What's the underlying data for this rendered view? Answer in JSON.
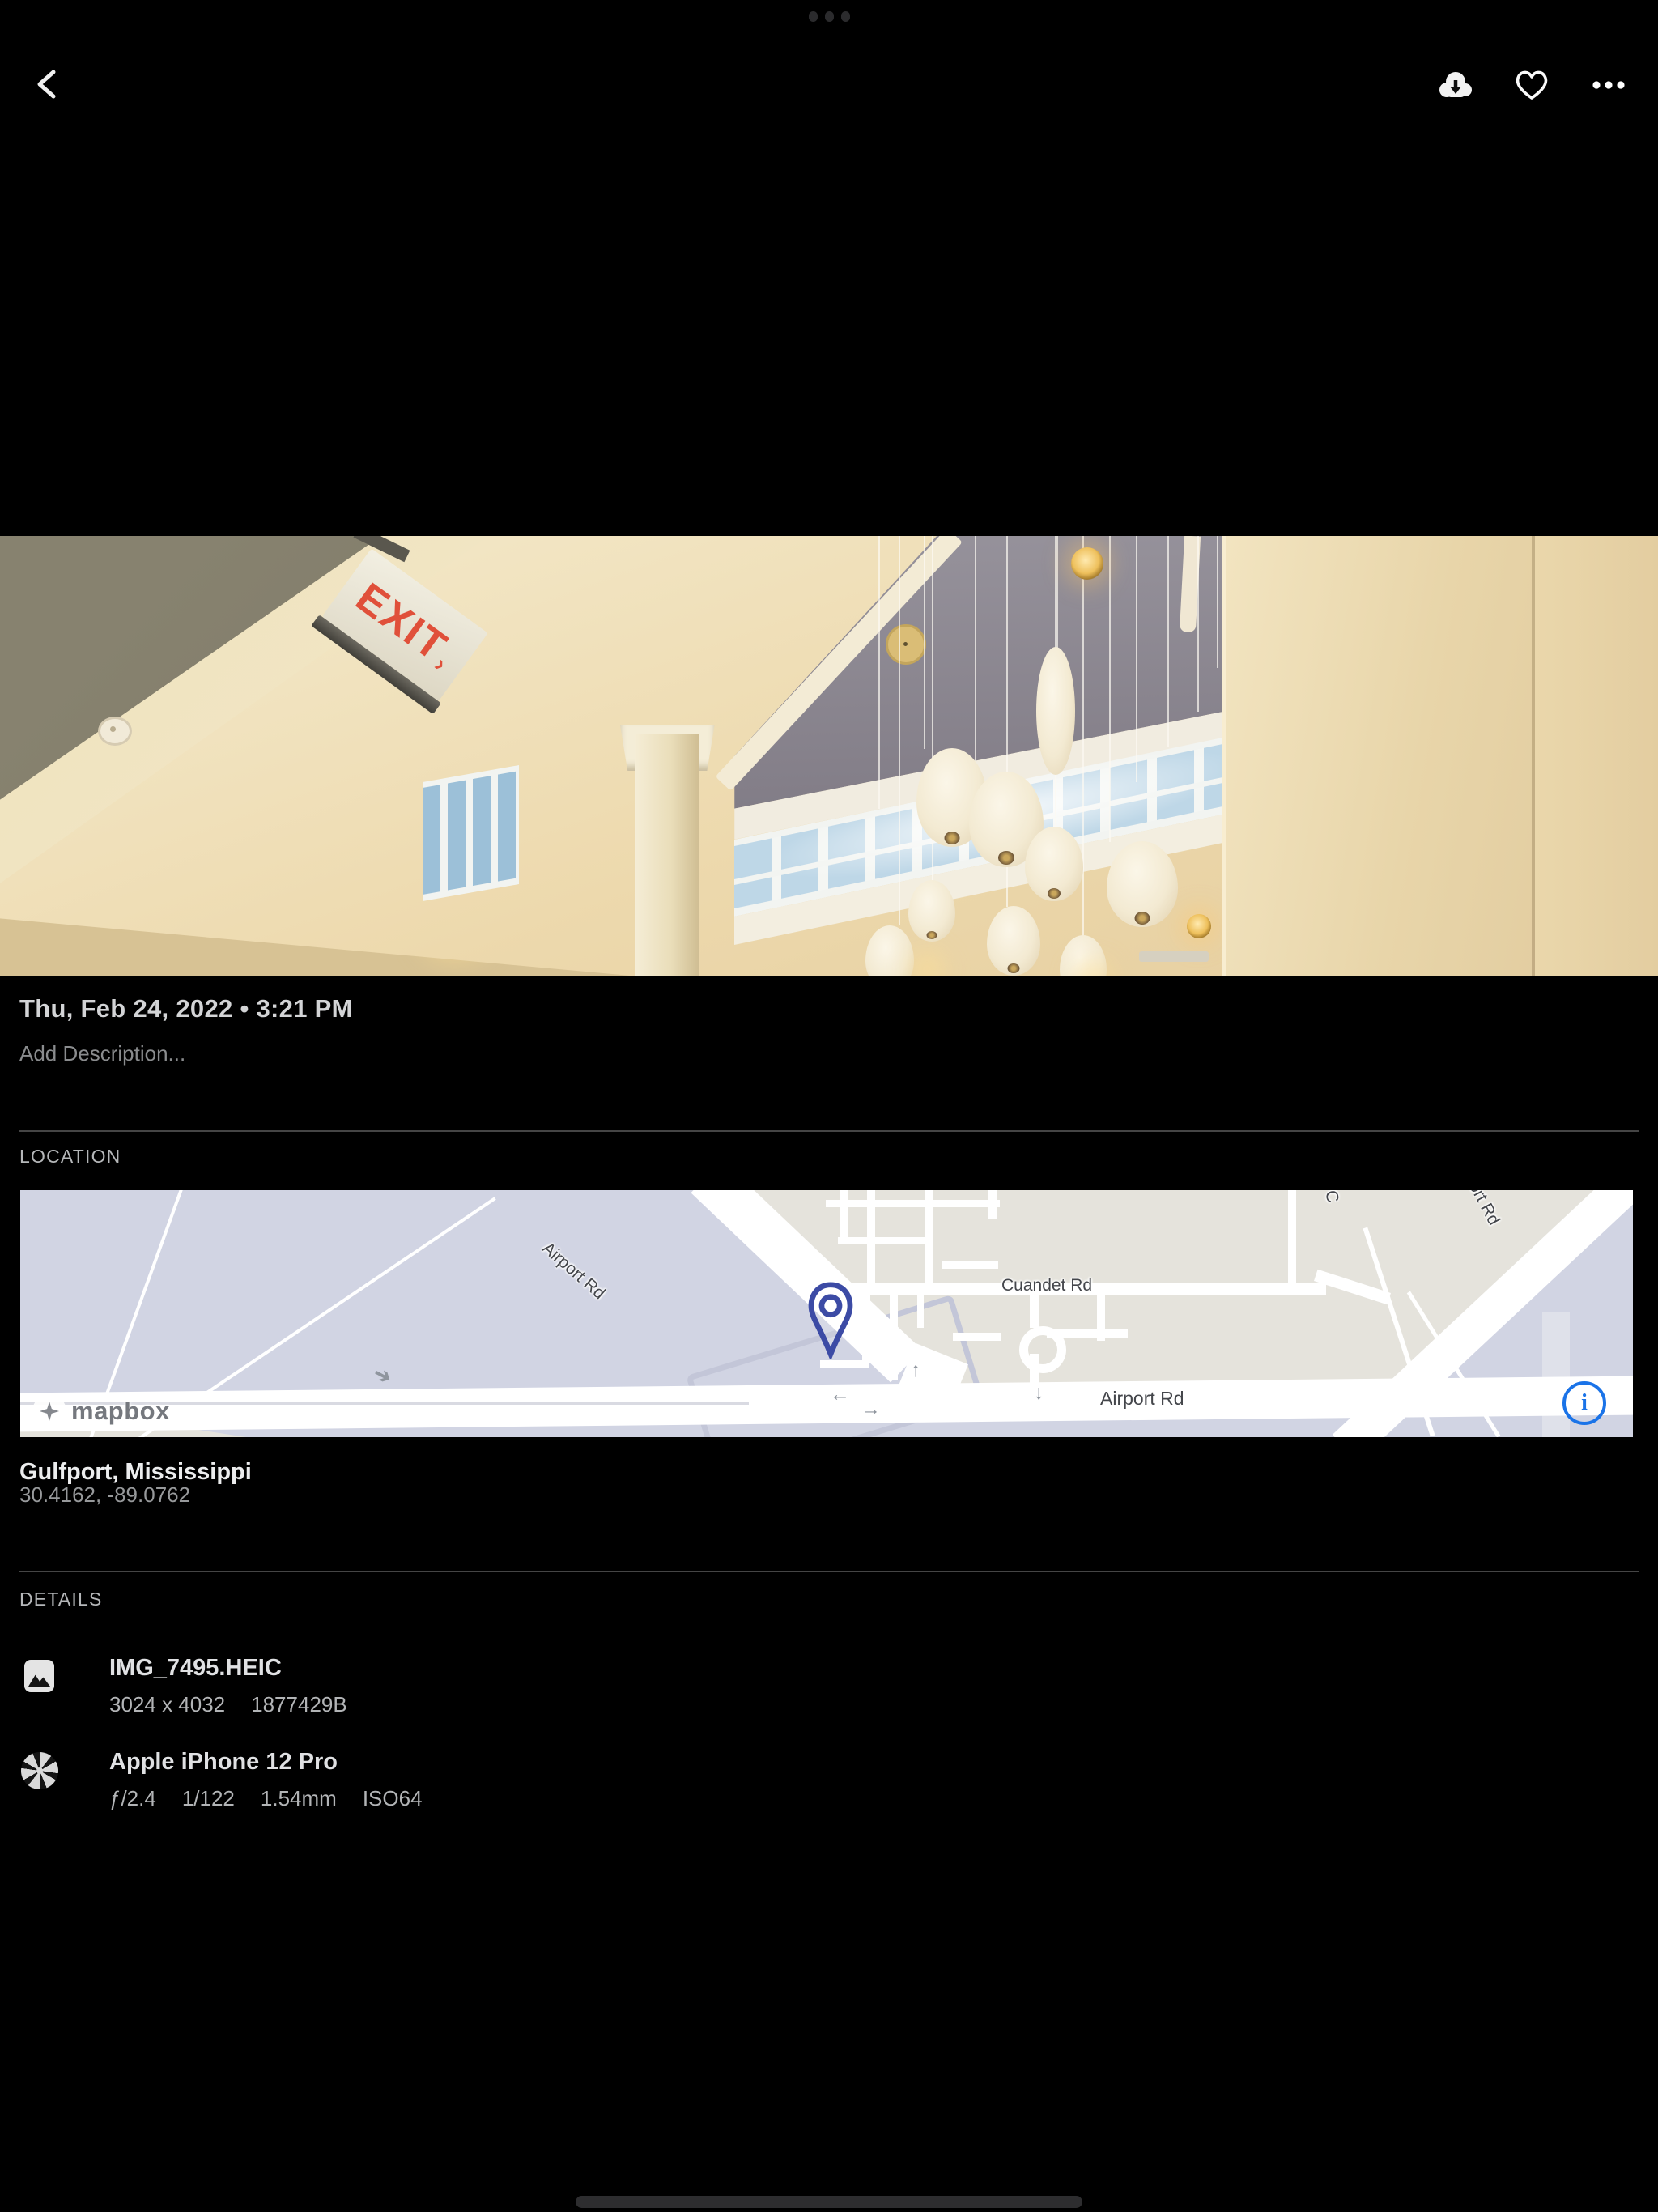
{
  "system": {
    "multitask_indicator_icon": "three-dots"
  },
  "topbar": {
    "back_icon": "chevron-left",
    "download_icon": "cloud-download",
    "favorite_icon": "heart-outline",
    "more_icon": "ellipsis-horizontal"
  },
  "photo": {
    "exit_text": "EXIT",
    "exit_arrow": "›"
  },
  "meta": {
    "date": "Thu, Feb 24, 2022 • 3:21 PM",
    "description_placeholder": "Add Description..."
  },
  "location": {
    "heading": "LOCATION",
    "place": "Gulfport, Mississippi",
    "coordinates": "30.4162, -89.0762",
    "map": {
      "attribution": "mapbox",
      "info_glyph": "i",
      "labels": {
        "airport_diag": "Airport Rd",
        "cuandet": "Cuandet Rd",
        "airport_bottom": "Airport Rd",
        "airport_right": "Airport Rd",
        "top_clip": "C"
      },
      "pin_color": "#3C4BA5",
      "info_color": "#1A73E8"
    }
  },
  "details": {
    "heading": "DETAILS",
    "file": {
      "title": "IMG_7495.HEIC",
      "dimensions": "3024 x 4032",
      "size": "1877429B"
    },
    "camera": {
      "title": "Apple iPhone 12 Pro",
      "aperture": "ƒ/2.4",
      "shutter": "1/122",
      "focal": "1.54mm",
      "iso": "ISO64"
    }
  }
}
